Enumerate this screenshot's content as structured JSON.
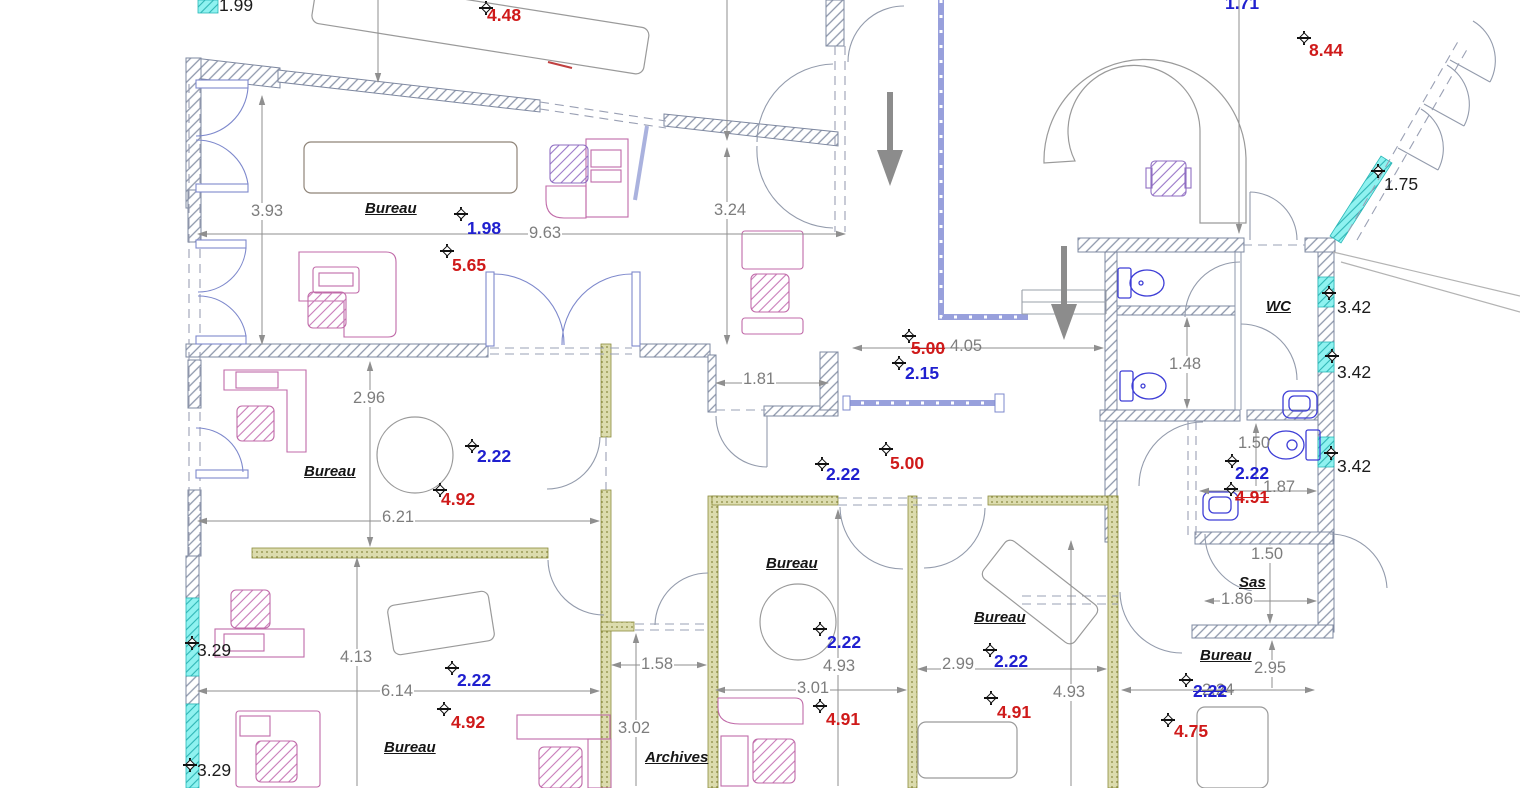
{
  "title": "Office floor plan (CAD view)",
  "colors": {
    "dimension_gray": "#7d7d7d",
    "annotation_blue": "#2020cf",
    "annotation_red": "#cf1a1a",
    "annotation_black": "#1c1c1c",
    "wall_hatch": "#8d97ab",
    "partition_olive": "#8b8b3d",
    "highlight_cyan": "#5fe8e8",
    "furniture_pink": "#c06aa8",
    "fixture_blue": "#3d3dd6"
  },
  "rooms": [
    "Bureau",
    "Bureau",
    "Bureau",
    "Bureau",
    "Bureau",
    "Bureau",
    "WC",
    "Sas",
    "Archives"
  ],
  "annotations": [
    {
      "text": "3.93",
      "kind": "dim",
      "x": 250,
      "y": 203
    },
    {
      "text": "9.63",
      "kind": "dim",
      "x": 528,
      "y": 225
    },
    {
      "text": "3.24",
      "kind": "dim",
      "x": 713,
      "y": 202
    },
    {
      "text": "4.05",
      "kind": "dimov",
      "x": 950,
      "y": 338
    },
    {
      "text": "1.81",
      "kind": "dim",
      "x": 742,
      "y": 371
    },
    {
      "text": "2.96",
      "kind": "dim",
      "x": 352,
      "y": 390
    },
    {
      "text": "6.21",
      "kind": "dim",
      "x": 381,
      "y": 509
    },
    {
      "text": "1.48",
      "kind": "dim",
      "x": 1168,
      "y": 356
    },
    {
      "text": "1.50",
      "kind": "dimov",
      "x": 1238,
      "y": 435
    },
    {
      "text": "1.87",
      "kind": "dimov",
      "x": 1263,
      "y": 479
    },
    {
      "text": "1.50",
      "kind": "dim",
      "x": 1250,
      "y": 546
    },
    {
      "text": "1.86",
      "kind": "dim",
      "x": 1220,
      "y": 591
    },
    {
      "text": "2.95",
      "kind": "dim",
      "x": 1253,
      "y": 660
    },
    {
      "text": "2.24",
      "kind": "dimov",
      "x": 1202,
      "y": 682,
      "strike": true
    },
    {
      "text": "4.13",
      "kind": "dim",
      "x": 339,
      "y": 649
    },
    {
      "text": "6.14",
      "kind": "dim",
      "x": 380,
      "y": 683
    },
    {
      "text": "1.58",
      "kind": "dim",
      "x": 640,
      "y": 656
    },
    {
      "text": "3.02",
      "kind": "dim",
      "x": 617,
      "y": 720
    },
    {
      "text": "4.93",
      "kind": "dim",
      "x": 822,
      "y": 658
    },
    {
      "text": "3.01",
      "kind": "dim",
      "x": 796,
      "y": 680
    },
    {
      "text": "2.99",
      "kind": "dim",
      "x": 941,
      "y": 656
    },
    {
      "text": "4.93",
      "kind": "dim",
      "x": 1052,
      "y": 684
    },
    {
      "text": "Bureau",
      "kind": "room",
      "x": 365,
      "y": 201
    },
    {
      "text": "Bureau",
      "kind": "room",
      "x": 304,
      "y": 464
    },
    {
      "text": "Bureau",
      "kind": "room",
      "x": 384,
      "y": 740
    },
    {
      "text": "Bureau",
      "kind": "room",
      "x": 766,
      "y": 556
    },
    {
      "text": "Bureau",
      "kind": "room",
      "x": 974,
      "y": 610
    },
    {
      "text": "Bureau",
      "kind": "room",
      "x": 1200,
      "y": 648
    },
    {
      "text": "WC",
      "kind": "room",
      "x": 1266,
      "y": 299
    },
    {
      "text": "Sas",
      "kind": "room",
      "x": 1239,
      "y": 575
    },
    {
      "text": "Archives",
      "kind": "room",
      "x": 645,
      "y": 750
    },
    {
      "text": "1.99",
      "kind": "black",
      "x": 219,
      "y": -4
    },
    {
      "text": "1.75",
      "kind": "black",
      "x": 1384,
      "y": 175
    },
    {
      "text": "3.42",
      "kind": "black",
      "x": 1337,
      "y": 298
    },
    {
      "text": "3.42",
      "kind": "black",
      "x": 1337,
      "y": 363
    },
    {
      "text": "3.42",
      "kind": "black",
      "x": 1337,
      "y": 457
    },
    {
      "text": "3.29",
      "kind": "black",
      "x": 197,
      "y": 641
    },
    {
      "text": "3.29",
      "kind": "black",
      "x": 197,
      "y": 761
    },
    {
      "text": "4.48",
      "kind": "red",
      "x": 487,
      "y": 6
    },
    {
      "text": "8.44",
      "kind": "red",
      "x": 1309,
      "y": 41
    },
    {
      "text": "5.65",
      "kind": "red",
      "x": 452,
      "y": 256
    },
    {
      "text": "5.00",
      "kind": "red",
      "x": 911,
      "y": 339,
      "strike": true
    },
    {
      "text": "5.00",
      "kind": "red",
      "x": 890,
      "y": 454
    },
    {
      "text": "4.92",
      "kind": "red",
      "x": 441,
      "y": 490
    },
    {
      "text": "4.91",
      "kind": "red",
      "x": 1235,
      "y": 488,
      "strike": true
    },
    {
      "text": "4.92",
      "kind": "red",
      "x": 451,
      "y": 713
    },
    {
      "text": "4.91",
      "kind": "red",
      "x": 826,
      "y": 710
    },
    {
      "text": "4.91",
      "kind": "red",
      "x": 997,
      "y": 703
    },
    {
      "text": "4.75",
      "kind": "red",
      "x": 1174,
      "y": 722
    },
    {
      "text": "1.71",
      "kind": "blue",
      "x": 1225,
      "y": -6
    },
    {
      "text": "1.98",
      "kind": "blue",
      "x": 467,
      "y": 219
    },
    {
      "text": "2.15",
      "kind": "blue",
      "x": 905,
      "y": 364
    },
    {
      "text": "2.22",
      "kind": "blue",
      "x": 477,
      "y": 447
    },
    {
      "text": "2.22",
      "kind": "blue",
      "x": 826,
      "y": 465
    },
    {
      "text": "2.22",
      "kind": "blue",
      "x": 1235,
      "y": 464
    },
    {
      "text": "2.22",
      "kind": "blue",
      "x": 457,
      "y": 671
    },
    {
      "text": "2.22",
      "kind": "blue",
      "x": 827,
      "y": 633
    },
    {
      "text": "2.22",
      "kind": "blue",
      "x": 994,
      "y": 652
    },
    {
      "text": "2.22",
      "kind": "blue",
      "x": 1193,
      "y": 682,
      "strike": true
    }
  ],
  "survey_markers": [
    {
      "x": 486,
      "y": 8
    },
    {
      "x": 1304,
      "y": 38
    },
    {
      "x": 1378,
      "y": 171
    },
    {
      "x": 461,
      "y": 214
    },
    {
      "x": 447,
      "y": 251
    },
    {
      "x": 909,
      "y": 336
    },
    {
      "x": 899,
      "y": 363
    },
    {
      "x": 1329,
      "y": 293
    },
    {
      "x": 1332,
      "y": 356
    },
    {
      "x": 1331,
      "y": 453
    },
    {
      "x": 472,
      "y": 446
    },
    {
      "x": 440,
      "y": 490
    },
    {
      "x": 822,
      "y": 464
    },
    {
      "x": 886,
      "y": 449
    },
    {
      "x": 1232,
      "y": 461
    },
    {
      "x": 1231,
      "y": 489
    },
    {
      "x": 192,
      "y": 643
    },
    {
      "x": 190,
      "y": 765
    },
    {
      "x": 452,
      "y": 668
    },
    {
      "x": 444,
      "y": 709
    },
    {
      "x": 820,
      "y": 629
    },
    {
      "x": 820,
      "y": 706
    },
    {
      "x": 990,
      "y": 650
    },
    {
      "x": 991,
      "y": 698
    },
    {
      "x": 1186,
      "y": 680
    },
    {
      "x": 1168,
      "y": 720
    }
  ]
}
